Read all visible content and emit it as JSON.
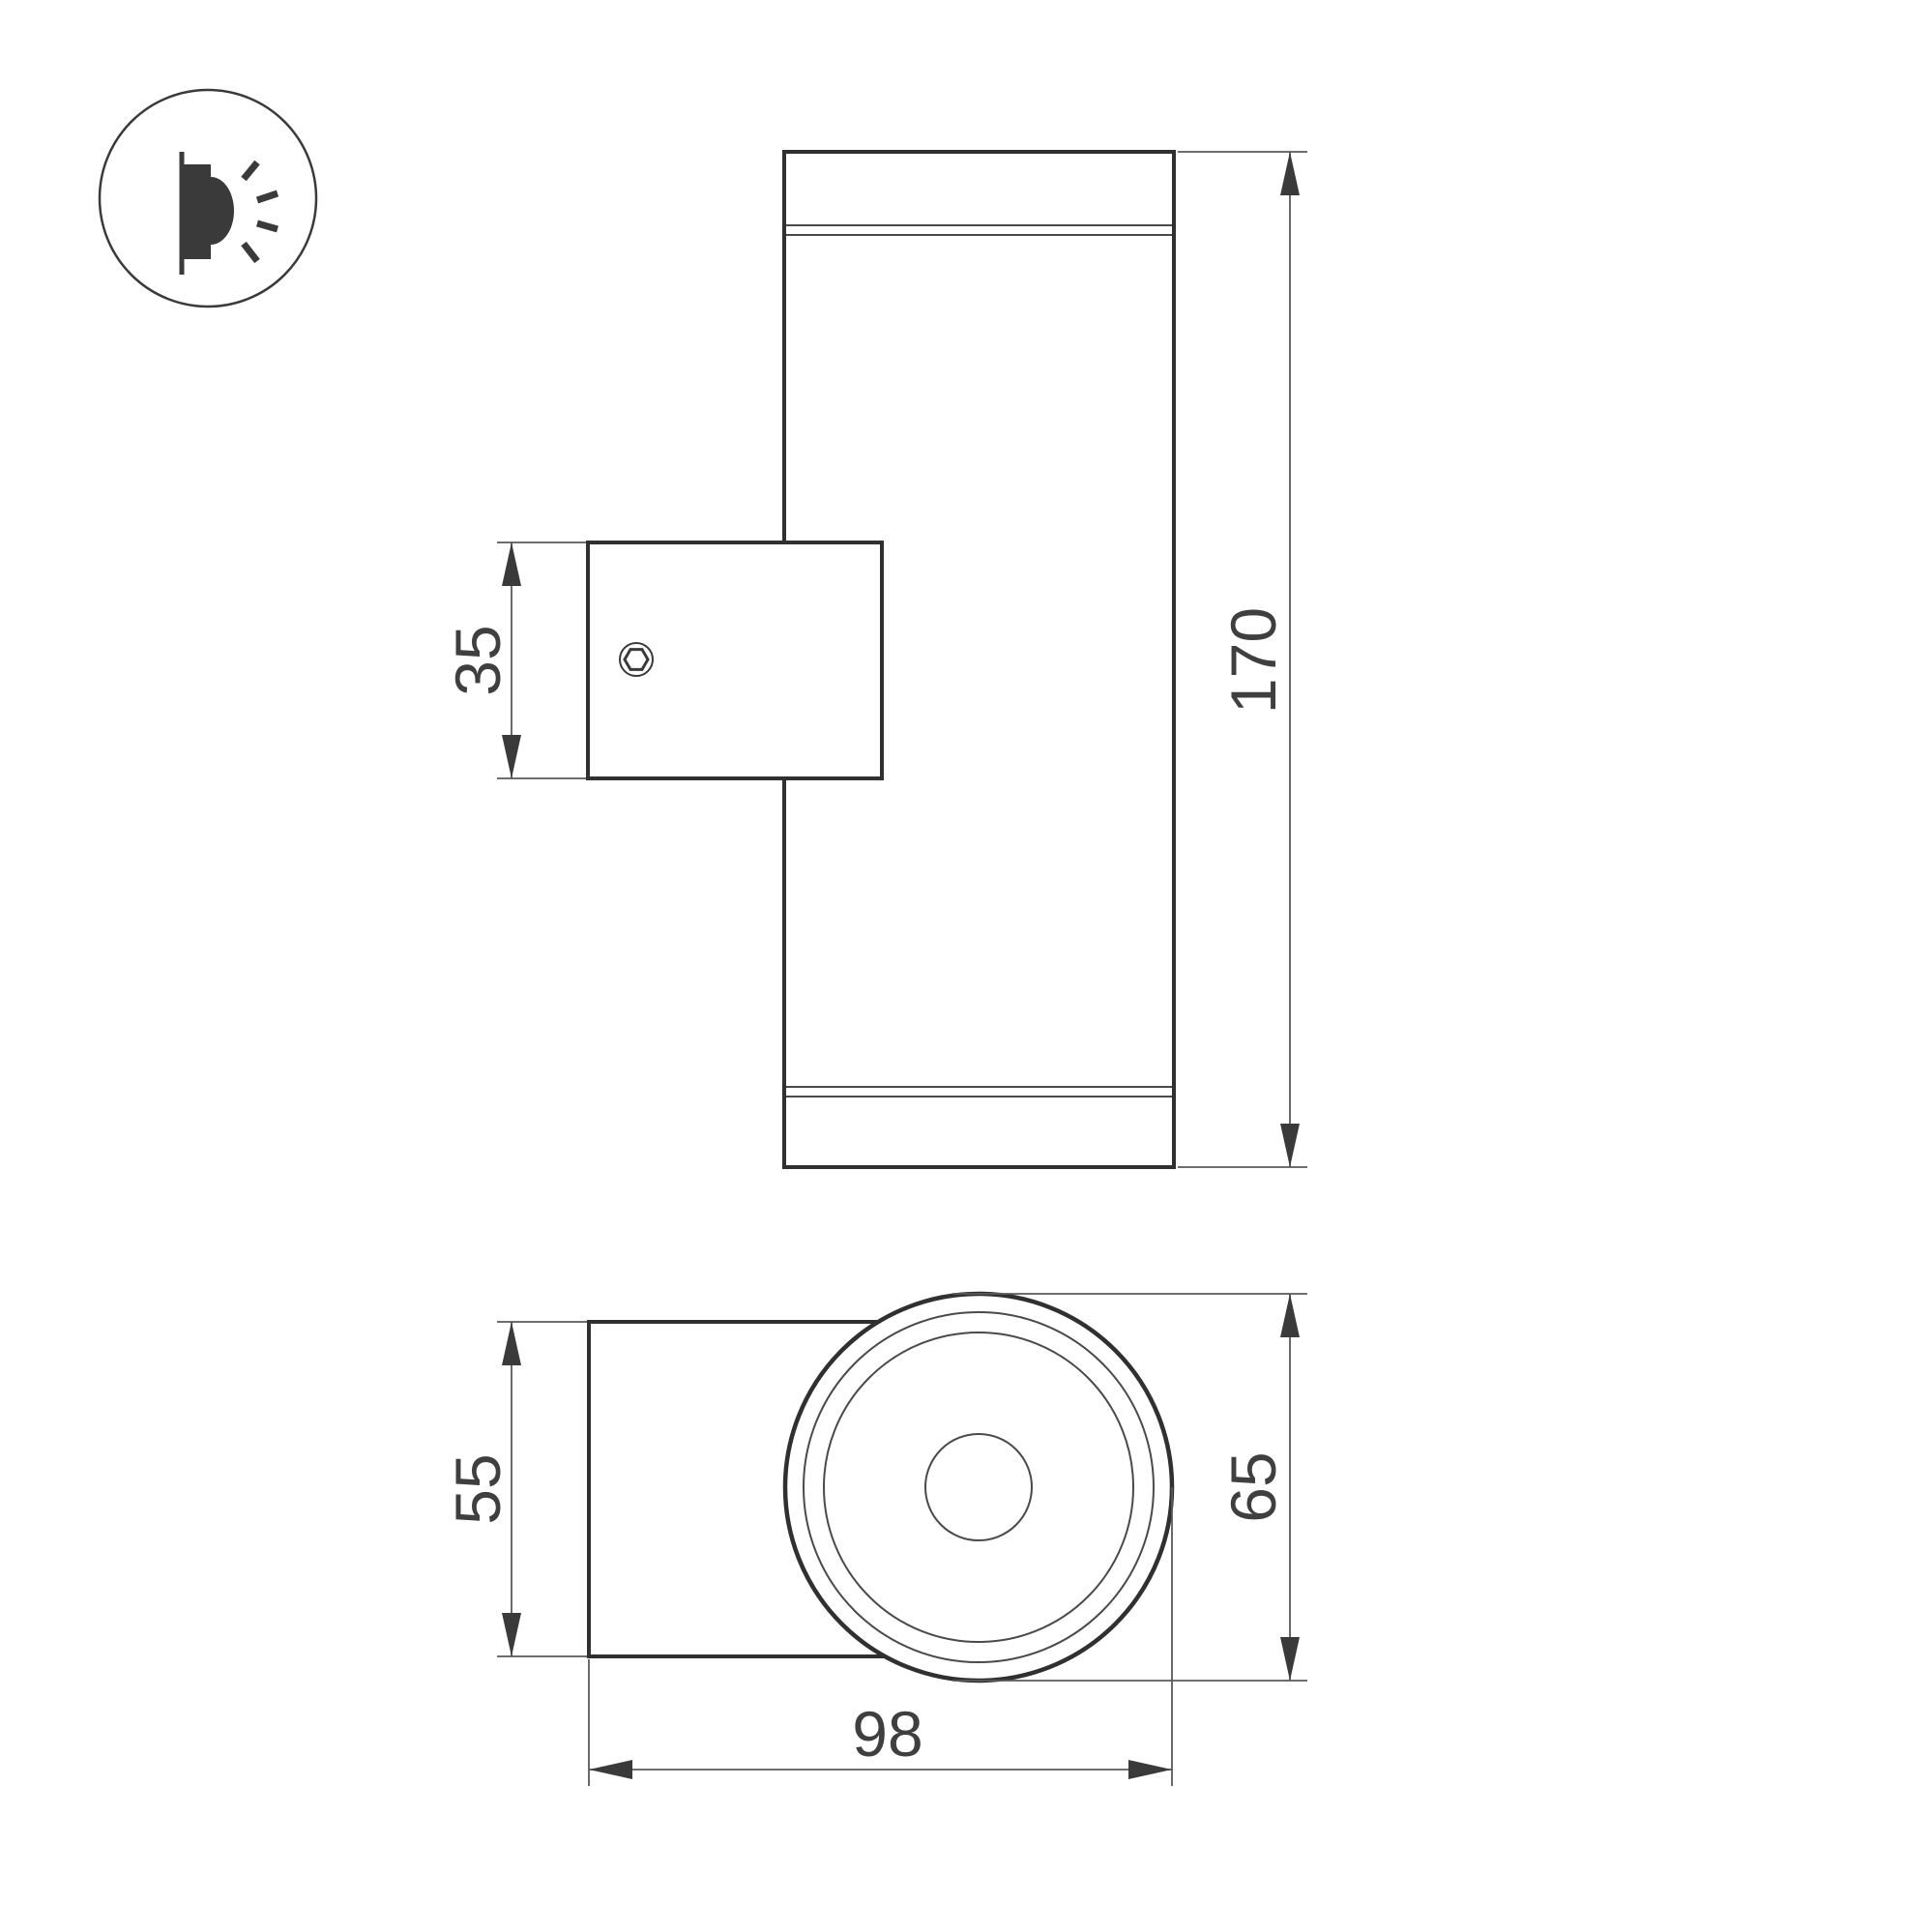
{
  "icon": {
    "name": "wall-mounted-light-icon"
  },
  "views": {
    "front": {
      "dimensions": {
        "bracket_height": "35",
        "overall_height": "170"
      }
    },
    "bottom": {
      "dimensions": {
        "bracket_width": "55",
        "body_diameter": "65",
        "overall_depth": "98"
      }
    }
  },
  "colors": {
    "background": "#ffffff",
    "outline": "#303030",
    "thin_line": "#595959",
    "annotation_text": "#3f3f3f",
    "arrow": "#3a3a3a"
  }
}
